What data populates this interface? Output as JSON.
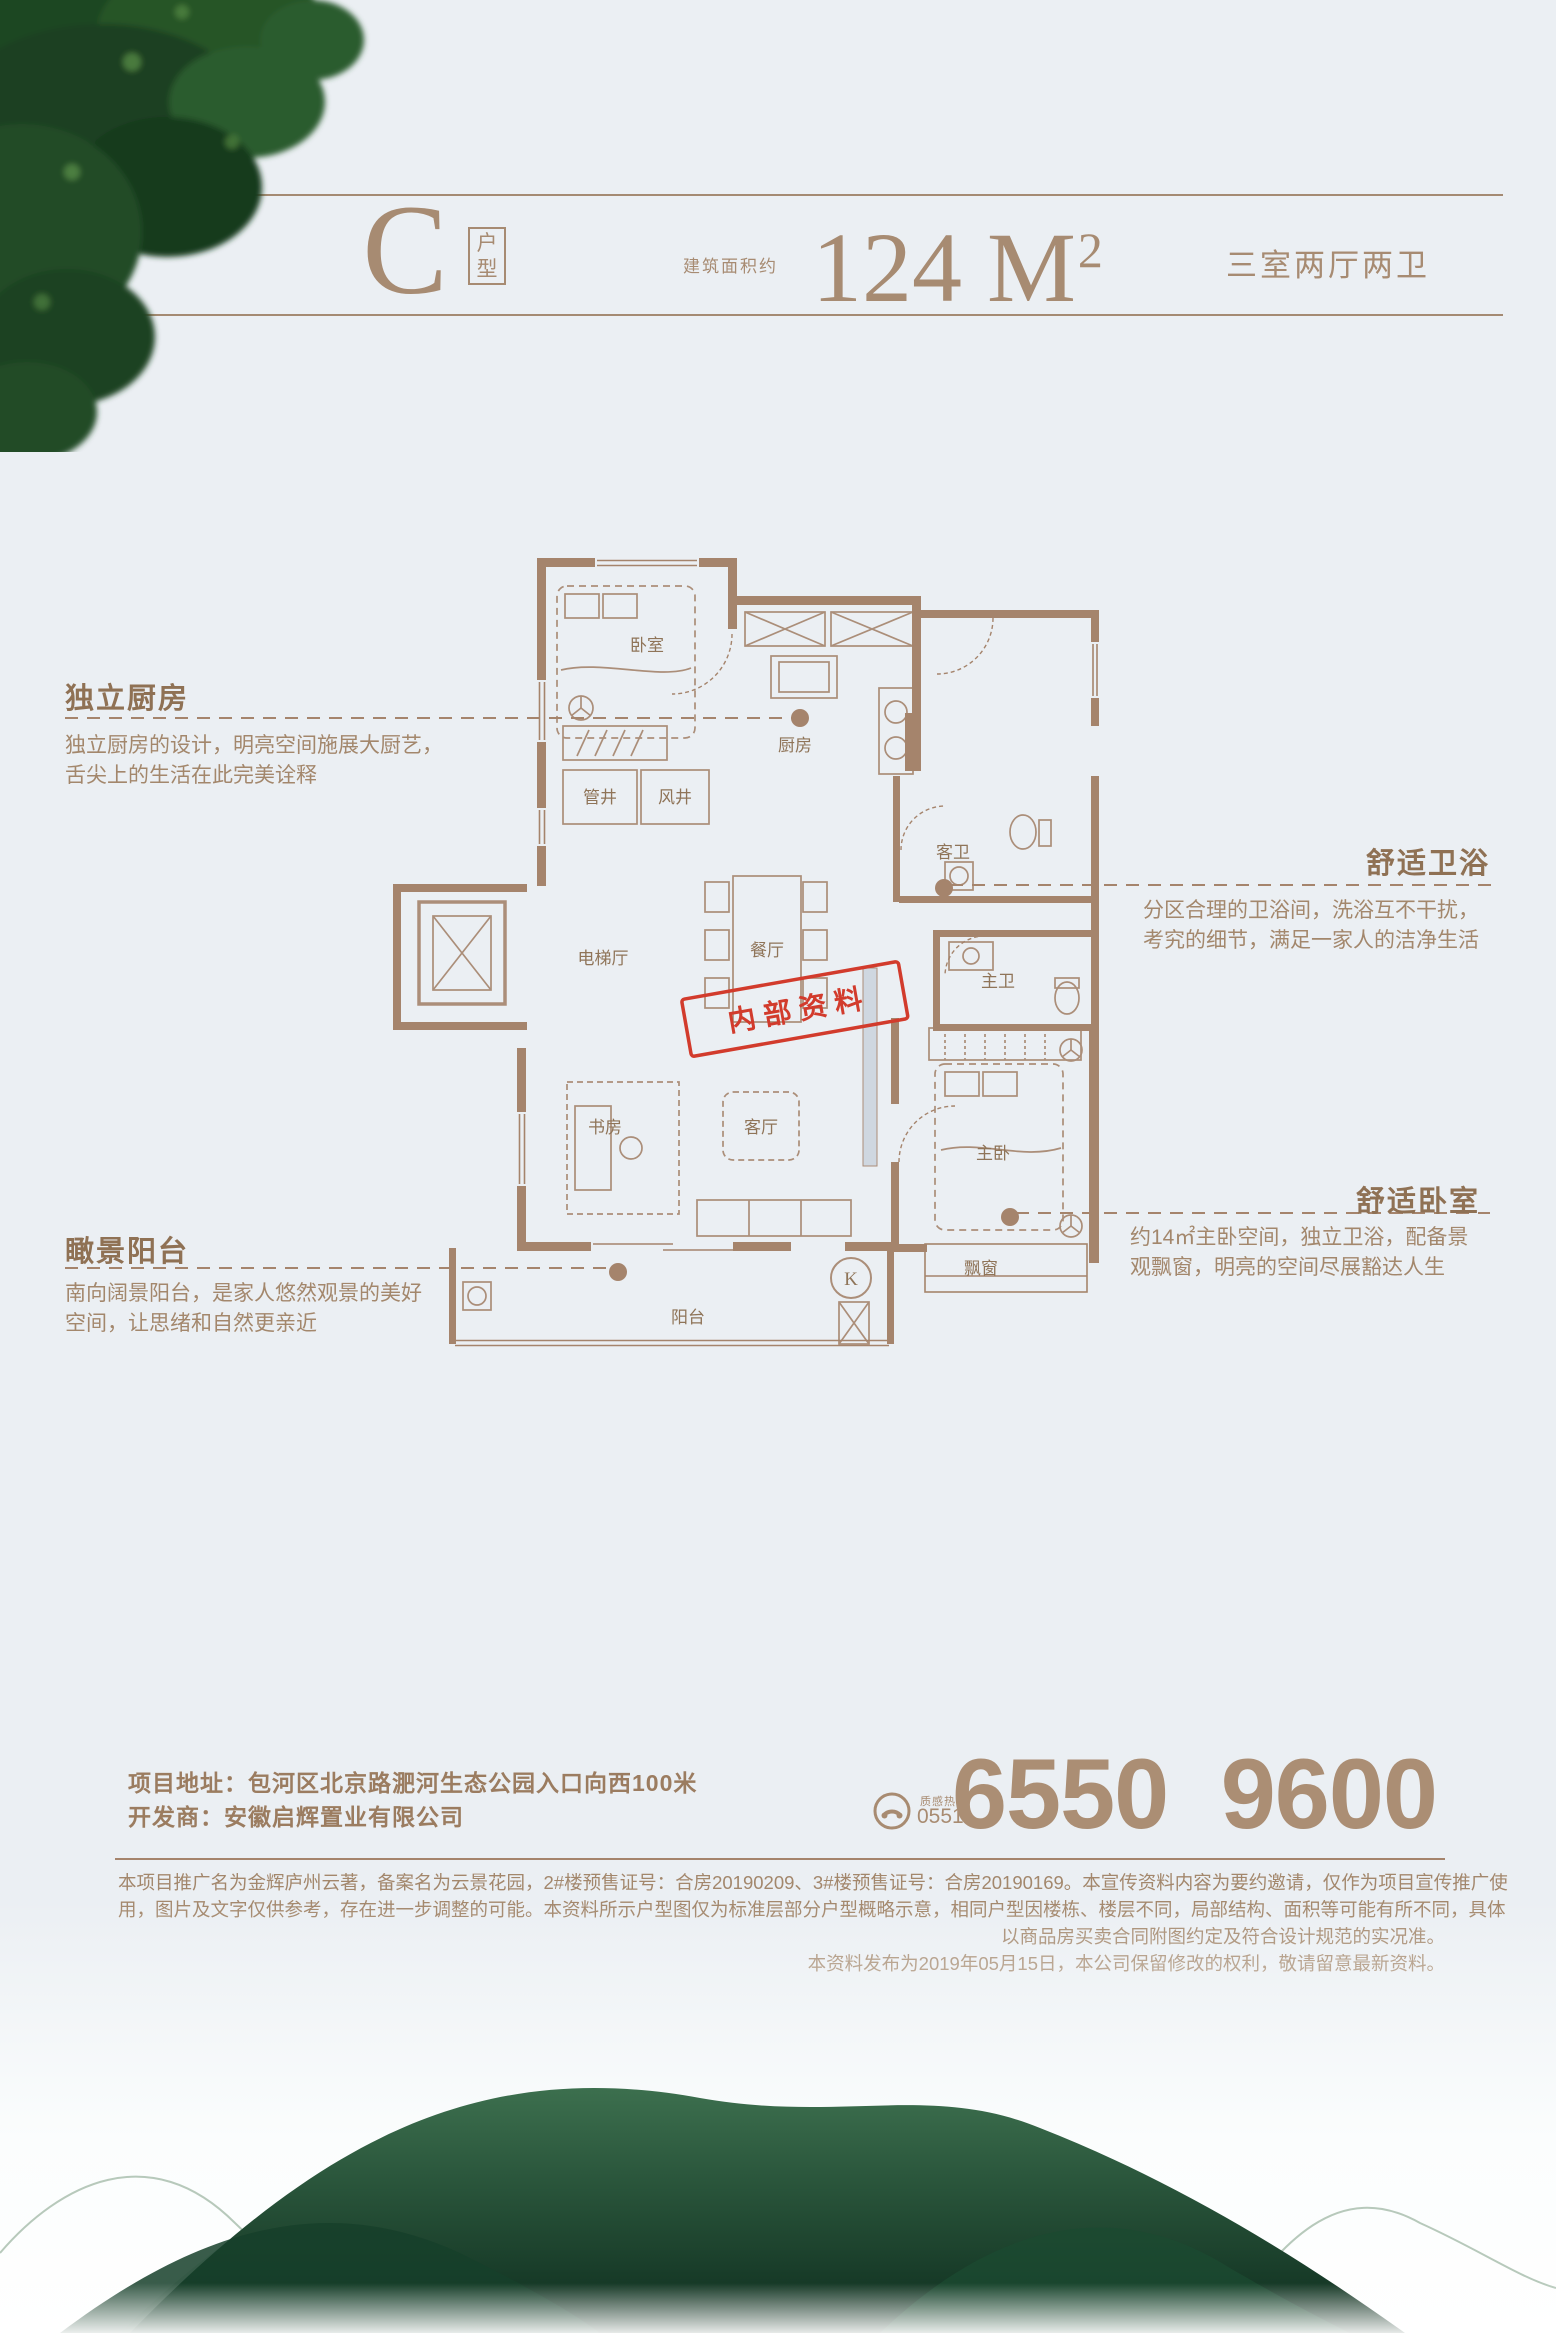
{
  "header": {
    "type_letter": "C",
    "type_label": "户型",
    "area_prefix": "建筑面积约",
    "area_value": "124 M",
    "area_sup": "2",
    "layout": "三室两厅两卫"
  },
  "annotations": {
    "kitchen": {
      "title": "独立厨房",
      "body1": "独立厨房的设计，明亮空间施展大厨艺，",
      "body2": "舌尖上的生活在此完美诠释"
    },
    "bath": {
      "title": "舒适卫浴",
      "body1": "分区合理的卫浴间，洗浴互不干扰，",
      "body2": "考究的细节，满足一家人的洁净生活"
    },
    "bedroom": {
      "title": "舒适卧室",
      "body1": "约14㎡主卧空间，独立卫浴，配备景",
      "body2": "观飘窗，明亮的空间尽展豁达人生"
    },
    "view_balcony": {
      "title": "瞰景阳台",
      "body1": "南向阔景阳台，是家人悠然观景的美好",
      "body2": "空间，让思绪和自然更亲近"
    }
  },
  "floorplan": {
    "stamp": "内部资料",
    "door_mark": "K",
    "rooms": {
      "bedroom2": "卧室",
      "kitchen": "厨房",
      "pipe_shaft": "管井",
      "air_shaft": "风井",
      "elevator_hall": "电梯厅",
      "dining": "餐厅",
      "guest_bath": "客卫",
      "master_bath": "主卫",
      "study": "书房",
      "living": "客厅",
      "master_bedroom": "主卧",
      "bay_window": "飘窗",
      "balcony": "阳台"
    }
  },
  "contact": {
    "address_label": "项目地址：",
    "address": "包河区北京路淝河生态公园入口向西100米",
    "developer_label": "开发商：",
    "developer": "安徽启辉置业有限公司",
    "hotline_label": "质感热线",
    "hotline_code": "0551",
    "phone": "6550 9600"
  },
  "legal": {
    "line1": "本项目推广名为金辉庐州云著，备案名为云景花园，2#楼预售证号：合房20190209、3#楼预售证号：合房20190169。本宣传资料内容为要约邀请，仅作为项目宣传推广使",
    "line2": "用，图片及文字仅供参考，存在进一步调整的可能。本资料所示户型图仅为标准层部分户型概略示意，相同户型因楼栋、楼层不同，局部结构、面积等可能有所不同，具体",
    "line3": "以商品房买卖合同附图约定及符合设计规范的实况准。",
    "line4": "本资料发布为2019年05月15日，本公司保留修改的权利，敬请留意最新资料。"
  },
  "colors": {
    "accent_taupe": "#a5846c",
    "header_taupe": "#a78b72",
    "stamp_red": "#d23b2c",
    "background": "#ebeff3",
    "forest_green": "#1d4a31"
  }
}
